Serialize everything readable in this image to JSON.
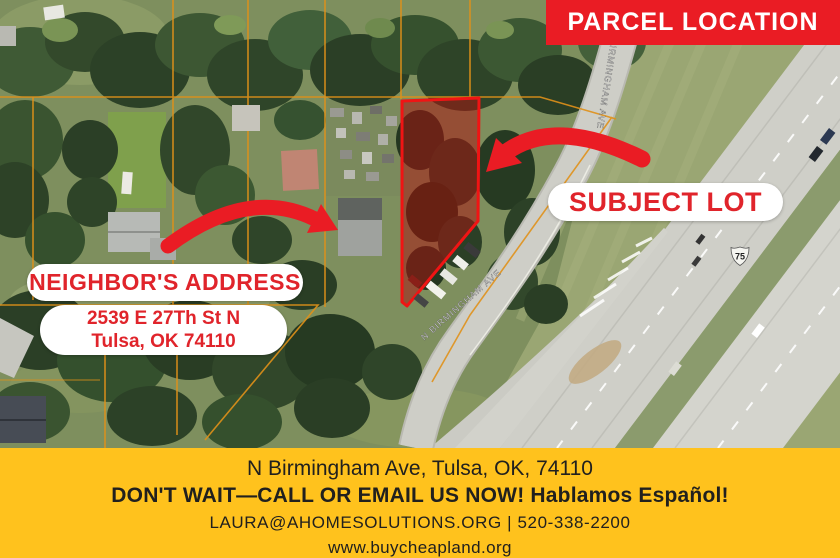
{
  "header": {
    "parcel_banner": "PARCEL LOCATION"
  },
  "map": {
    "subject_lot_label": "SUBJECT LOT",
    "neighbor_label": "NEIGHBOR'S ADDRESS",
    "neighbor_address_line1": "2539 E 27Th St N",
    "neighbor_address_line2": "Tulsa, OK 74110",
    "street_label_top": "N BIRMINGHAM AVE",
    "street_label_bottom": "N BIRMINGHAM AVE",
    "highway_shield": "75"
  },
  "footer": {
    "address": "N Birmingham Ave, Tulsa, OK, 74110",
    "cta": "DON'T WAIT—CALL OR EMAIL US NOW! Hablamos Español!",
    "contact": "LAURA@AHOMESOLUTIONS.ORG | 520-338-2200",
    "website": "www.buycheapland.org"
  },
  "colors": {
    "brand_red": "#ea1c24",
    "banner_yellow": "#ffc21d",
    "pill_text_red": "#e0242b",
    "footer_text": "#21201e",
    "parcel_outline": "#f01414",
    "parcel_grid_orange": "#e09119"
  }
}
